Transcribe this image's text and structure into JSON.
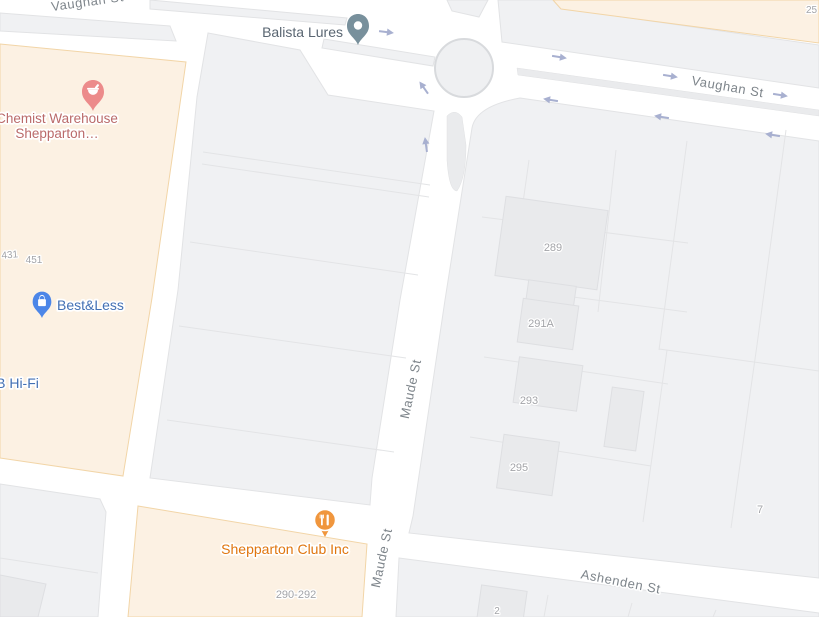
{
  "view": {
    "type": "map",
    "width": 819,
    "height": 617
  },
  "streets": {
    "vaughan_partial": "Vaughan St",
    "vaughan": "Vaughan St",
    "maude_upper": "Maude St",
    "maude_lower": "Maude St",
    "ashenden": "Ashenden St"
  },
  "places": {
    "balista": {
      "label": "Balista Lures",
      "type": "generic-place"
    },
    "chemist": {
      "line1": "Chemist Warehouse",
      "line2": "Shepparton…",
      "type": "pharmacy"
    },
    "bestless": {
      "label": "Best&Less",
      "type": "shopping"
    },
    "jbhifi": {
      "label": "JB Hi-Fi",
      "type": "shopping"
    },
    "sheppclub": {
      "label": "Shepparton Club Inc",
      "type": "restaurant"
    }
  },
  "parcel_numbers": {
    "n25": "25",
    "n431": "431",
    "n451": "451",
    "n289": "289",
    "n291a": "291A",
    "n293": "293",
    "n295": "295",
    "n290_292": "290-292",
    "n7": "7",
    "n2": "2"
  },
  "colors": {
    "road": "#FFFFFF",
    "parcel_fill": "#F0F1F3",
    "commercial_fill": "#FCF1E3",
    "building_fill": "#E9EAEC",
    "street_text": "#7E858B",
    "address_text": "#A3A4A8",
    "arrow": "#A8B0D0",
    "generic_pin": "#78909C",
    "generic_text": "#5A6672",
    "pharmacy_pin": "#EC8B8B",
    "pharmacy_text": "#BA6A6A",
    "shopping_pin": "#4C86E8",
    "shopping_text": "#4370B4",
    "restaurant_pin": "#F0963D",
    "restaurant_text": "#E0760F"
  }
}
